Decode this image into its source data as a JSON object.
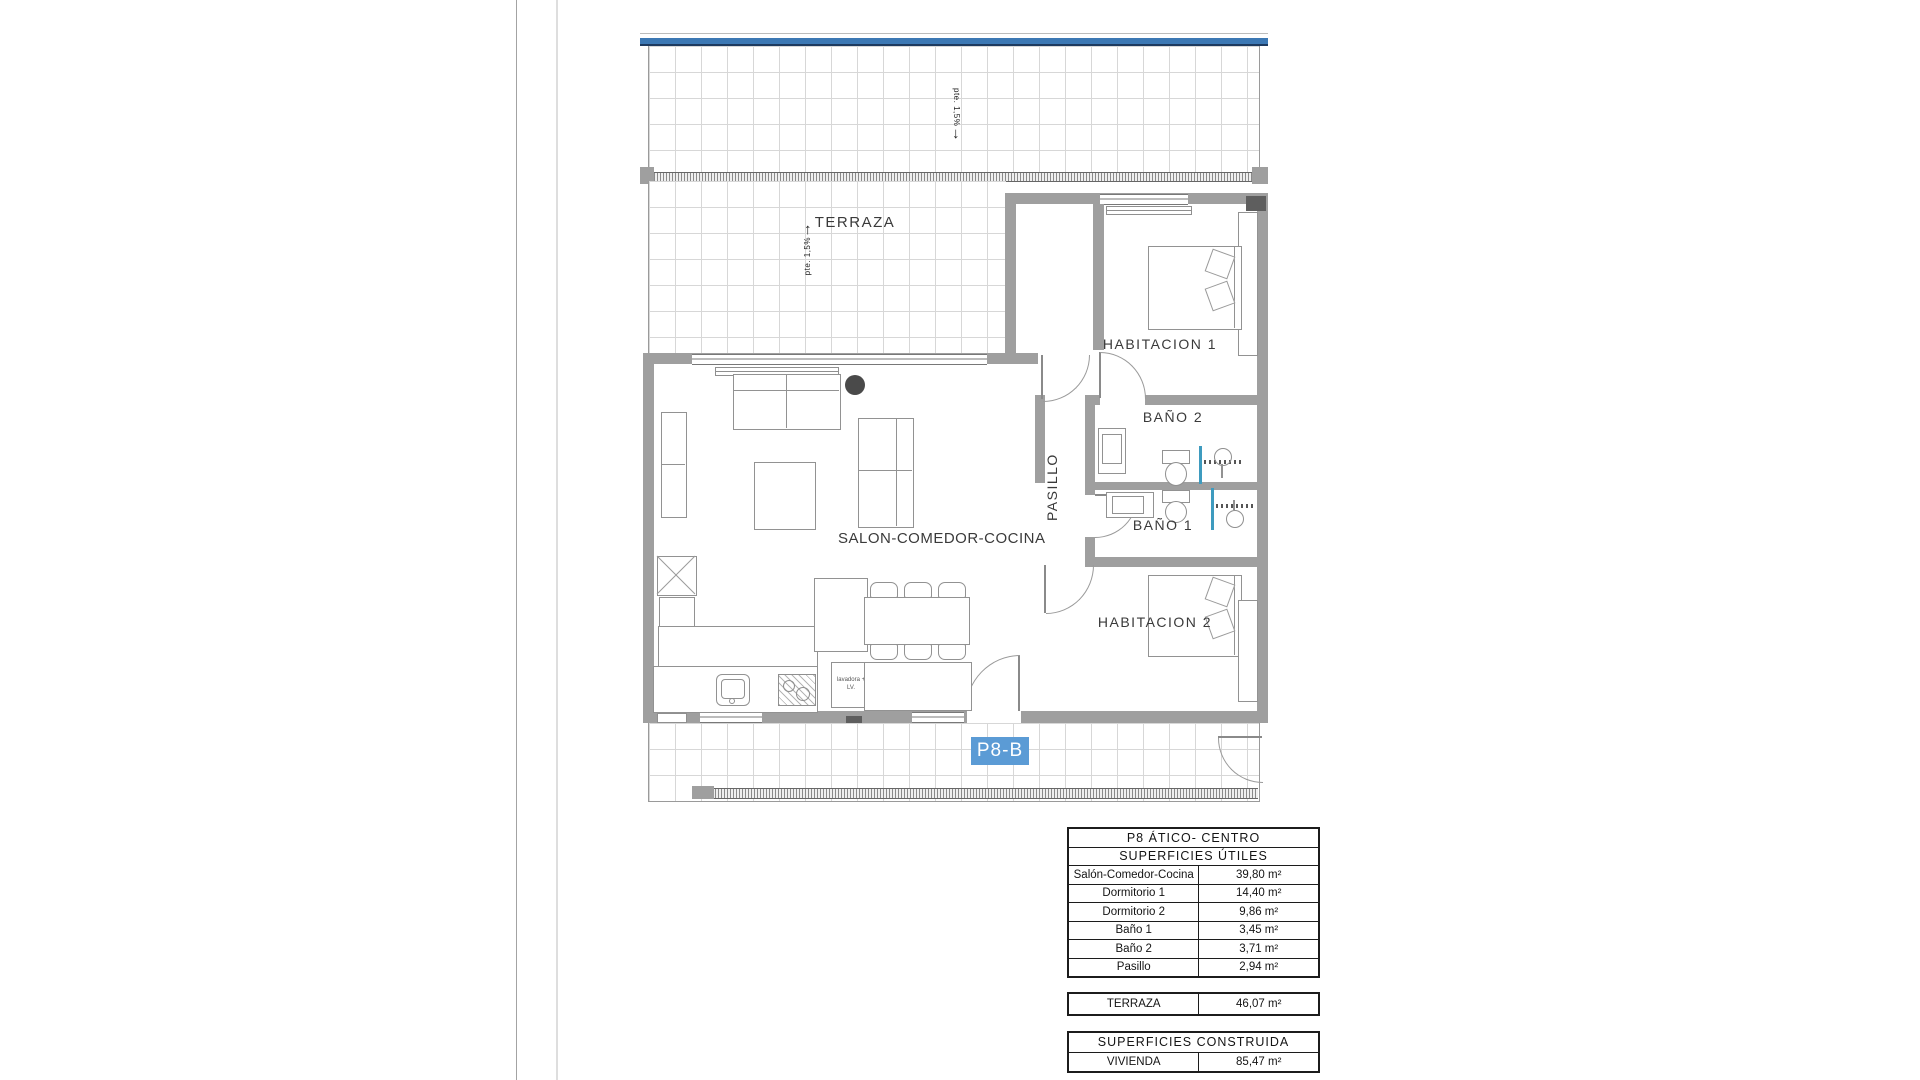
{
  "plan": {
    "rooms": {
      "terraza": "TERRAZA",
      "salon": "SALON-COMEDOR-COCINA",
      "pasillo": "PASILLO",
      "habitacion1": "HABITACION 1",
      "habitacion2": "HABITACION 2",
      "bano1": "BAÑO 1",
      "bano2": "BAÑO 2"
    },
    "unit_tag": "P8-B",
    "annotations": {
      "slope_top_text": "pte. 1,5%",
      "slope_top_arrow": "↓",
      "slope_terrace_text": "pte. 1,5%",
      "slope_terrace_arrow": "↑",
      "appliance_note": "lavadora + LV."
    },
    "colors": {
      "wall_gray": "#9f9f9f",
      "tag_blue": "#5b9bd5",
      "band_blue": "#3c78b4",
      "band_navy": "#1d3a5f",
      "shower_glass_blue": "#3e9bbf"
    }
  },
  "tables": {
    "useful": {
      "title": "P8 ÁTICO- CENTRO",
      "subtitle": "SUPERFICIES ÚTILES",
      "rows": [
        {
          "label": "Salón-Comedor-Cocina",
          "value": "39,80 m²"
        },
        {
          "label": "Dormitorio 1",
          "value": "14,40 m²"
        },
        {
          "label": "Dormitorio 2",
          "value": "9,86 m²"
        },
        {
          "label": "Baño 1",
          "value": "3,45 m²"
        },
        {
          "label": "Baño 2",
          "value": "3,71 m²"
        },
        {
          "label": "Pasillo",
          "value": "2,94 m²"
        }
      ]
    },
    "terraza_row": {
      "label": "TERRAZA",
      "value": "46,07 m²"
    },
    "built": {
      "title": "SUPERFICIES CONSTRUIDA",
      "rows": [
        {
          "label": "VIVIENDA",
          "value": "85,47 m²"
        }
      ]
    }
  }
}
